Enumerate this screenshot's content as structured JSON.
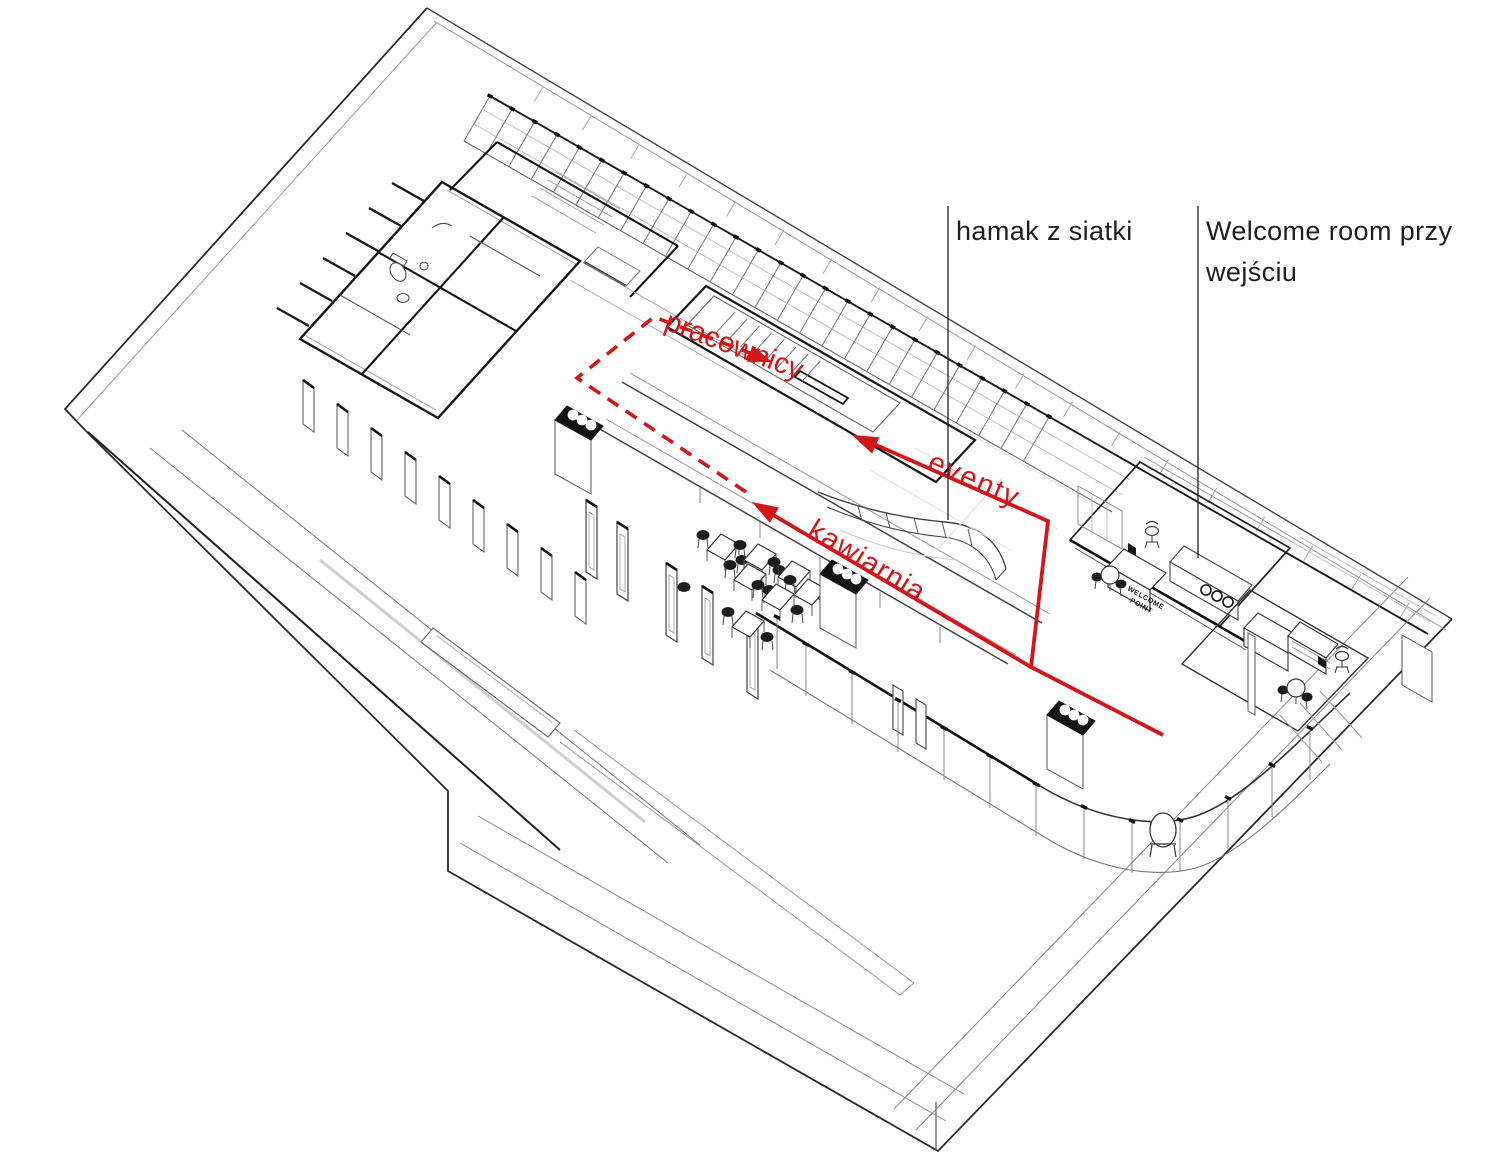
{
  "annotations": {
    "hamak_label": "hamak z siatki",
    "welcome_label_line1": "Welcome room przy",
    "welcome_label_line2": "wejściu",
    "route_pracownicy": "pracownicy",
    "route_eventy": "eventy",
    "route_kawiarnia": "kawiarnia",
    "welcome_point_sign_line1": "WELCOME",
    "welcome_point_sign_line2": "POINT"
  },
  "colors": {
    "route_red": "#d2161a",
    "ink": "#1f1f1f",
    "paper": "#ffffff"
  }
}
